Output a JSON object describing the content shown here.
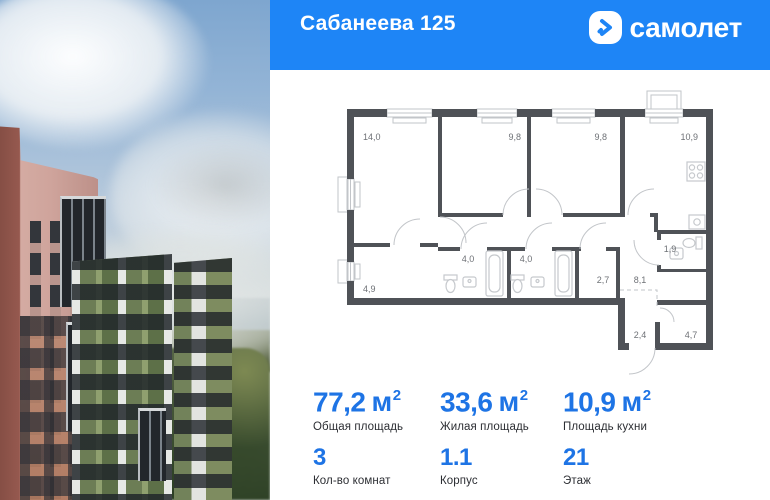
{
  "header": {
    "title": "Сабанеева 125",
    "brand": "самолет"
  },
  "plan": {
    "rooms": [
      {
        "name": "room-1",
        "area": "14,0"
      },
      {
        "name": "room-2",
        "area": "9,8"
      },
      {
        "name": "room-3",
        "area": "9,8"
      },
      {
        "name": "kitchen",
        "area": "10,9"
      },
      {
        "name": "room-left",
        "area": "4,9"
      },
      {
        "name": "bathroom-1",
        "area": "4,0"
      },
      {
        "name": "bathroom-2",
        "area": "4,0"
      },
      {
        "name": "wardrobe",
        "area": "2,7"
      },
      {
        "name": "hallway",
        "area": "8,1"
      },
      {
        "name": "wc",
        "area": "1,9"
      },
      {
        "name": "entry",
        "area": "2,4"
      },
      {
        "name": "storage",
        "area": "4,7"
      }
    ]
  },
  "stats": {
    "areas": [
      {
        "value": "77,2",
        "unit": "м",
        "sup": "2",
        "label": "Общая площадь"
      },
      {
        "value": "33,6",
        "unit": "м",
        "sup": "2",
        "label": "Жилая площадь"
      },
      {
        "value": "10,9",
        "unit": "м",
        "sup": "2",
        "label": "Площадь кухни"
      }
    ],
    "details": [
      {
        "value": "3",
        "label": "Кол-во комнат"
      },
      {
        "value": "1.1",
        "label": "Корпус"
      },
      {
        "value": "21",
        "label": "Этаж"
      }
    ]
  },
  "colors": {
    "header_blue": "#1E85F6",
    "accent_blue": "#1E74E5",
    "wall_gray": "#4F5257"
  }
}
